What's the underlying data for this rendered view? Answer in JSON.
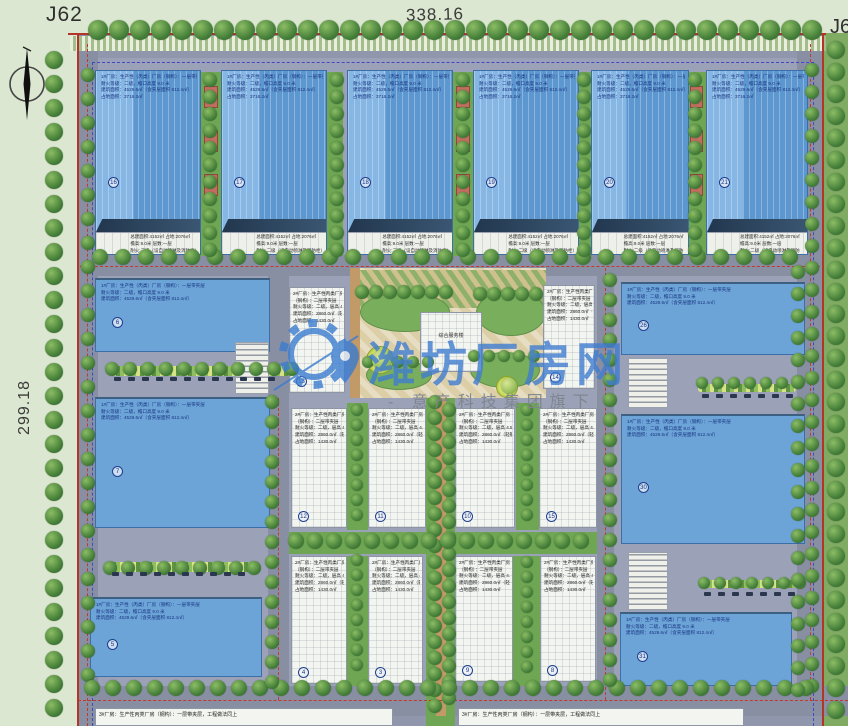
{
  "title_labels": {
    "top_left": "J62",
    "top_right": "J63",
    "top_dim": "338.16",
    "left_dim": "299.18"
  },
  "watermark": {
    "title": "潍坊厂房网",
    "subtitle": "-  意产科技集团旗下",
    "title_color": "#3b7cd0",
    "subtitle_color": "#8e949c"
  },
  "central_building_label": "综合服务楼",
  "annotations": {
    "blue_lines": [
      "1#厂房：生产性（丙类）厂房（钢构）：一层带夹层",
      "耐火等级：二级，檐口高度 9.0 米",
      "建筑面积：4529.6㎡（含夹层面积 812.4㎡）",
      "占地面积：3716.2㎡"
    ],
    "white_lines": [
      "2#厂房：生产性丙类厂房（砼框架）",
      "（钢构）：二层带夹层",
      "耐火等级：二级，层高 4.5 米",
      "建筑面积：2860.0㎡（轻钢屋面彩钢板）",
      "占地面积：1430.0㎡"
    ],
    "band_lines": [
      "总建面积:4152㎡ 占地:2076㎡",
      "檐高:9.0米 层数:一层",
      "耐火:二级（设自动喷淋及消防栓）"
    ],
    "bottom_lines": [
      "3#厂房：生产性丙类厂房（钢构）：一层带夹层，工程做法同上"
    ]
  },
  "colors": {
    "roof_blue_light": "#86b6e4",
    "roof_blue": "#5d97d0",
    "ridge_navy": "#22374e",
    "ground_grey": "#9096ab",
    "boundary_red": "#b23527",
    "inner_dash_blue": "#3f49c4",
    "tree_green": "#46803a",
    "plaza_tan": "#dccfa8",
    "outside_green": "#dbe7d0"
  },
  "layout": {
    "base": [
      77,
      33,
      747,
      693
    ],
    "right_green": [
      824,
      33,
      24,
      693
    ],
    "hedge_band": [
      70,
      36,
      756,
      15
    ],
    "lots": [
      [
        90,
        58,
        720,
        198
      ],
      [
        82,
        276,
        186,
        438
      ],
      [
        289,
        276,
        308,
        438
      ],
      [
        614,
        276,
        196,
        438
      ]
    ],
    "roads": [
      [
        77,
        33,
        21,
        693
      ],
      [
        797,
        33,
        27,
        681
      ],
      [
        77,
        255,
        747,
        21
      ],
      [
        77,
        686,
        771,
        30
      ],
      [
        268,
        258,
        21,
        468
      ],
      [
        597,
        258,
        17,
        468
      ]
    ],
    "greens": [
      [
        201,
        72,
        20,
        184
      ],
      [
        327,
        72,
        16,
        184
      ],
      [
        453,
        72,
        20,
        184
      ],
      [
        577,
        72,
        14,
        184
      ],
      [
        687,
        72,
        19,
        184
      ],
      [
        347,
        403,
        21,
        127
      ],
      [
        516,
        403,
        23,
        127
      ],
      [
        347,
        556,
        21,
        130
      ],
      [
        513,
        556,
        27,
        130
      ],
      [
        426,
        398,
        29,
        328
      ],
      [
        289,
        532,
        308,
        22
      ]
    ],
    "plaza": [
      356,
      268,
      190,
      130
    ],
    "field": [
      356,
      270,
      190,
      38
    ],
    "paths": [
      [
        350,
        268,
        10,
        130
      ],
      [
        436,
        398,
        10,
        318
      ]
    ],
    "lawns": [
      [
        360,
        292,
        90,
        40
      ],
      [
        476,
        290,
        70,
        46
      ],
      [
        366,
        360,
        66,
        30
      ],
      [
        470,
        352,
        70,
        36
      ]
    ],
    "ycircles": [
      [
        366,
        346,
        28
      ],
      [
        496,
        376,
        22
      ]
    ],
    "hedges": [
      [
        112,
        366,
        180,
        10
      ],
      [
        108,
        562,
        150,
        10
      ],
      [
        698,
        384,
        98,
        8
      ],
      [
        700,
        580,
        96,
        8
      ]
    ],
    "red_solid": [
      [
        68,
        33,
        758,
        2
      ],
      [
        77,
        33,
        2,
        693
      ],
      [
        822,
        33,
        2,
        693
      ]
    ],
    "red_dash_h": [
      [
        80,
        266,
        740
      ],
      [
        78,
        700,
        770
      ]
    ],
    "red_dash_v": [
      [
        87,
        44,
        682
      ],
      [
        278,
        398,
        302
      ],
      [
        605,
        268,
        432
      ],
      [
        810,
        44,
        656
      ]
    ],
    "blue_dash": [
      92,
      62,
      722,
      664
    ],
    "car_rows": [
      [
        114,
        377,
        14,
        12
      ],
      [
        112,
        572,
        14,
        10
      ],
      [
        702,
        394,
        14,
        7
      ],
      [
        704,
        592,
        14,
        7
      ]
    ],
    "tree_rows": [
      [
        98,
        30,
        21,
        0,
        35,
        10
      ],
      [
        54,
        60,
        0,
        24,
        28,
        9
      ],
      [
        836,
        50,
        0,
        22,
        31,
        9
      ],
      [
        100,
        257,
        23,
        0,
        31,
        8
      ],
      [
        88,
        75,
        0,
        24,
        26,
        7
      ],
      [
        812,
        70,
        0,
        22,
        29,
        7
      ],
      [
        210,
        80,
        0,
        17,
        11,
        7
      ],
      [
        337,
        80,
        0,
        17,
        11,
        7
      ],
      [
        463,
        80,
        0,
        17,
        11,
        7
      ],
      [
        584,
        80,
        0,
        17,
        11,
        7
      ],
      [
        695,
        80,
        0,
        17,
        11,
        7
      ],
      [
        435,
        402,
        0,
        16,
        20,
        7
      ],
      [
        449,
        410,
        0,
        16,
        19,
        7
      ],
      [
        357,
        410,
        0,
        15,
        8,
        6
      ],
      [
        527,
        410,
        0,
        15,
        8,
        6
      ],
      [
        357,
        560,
        0,
        15,
        8,
        6
      ],
      [
        527,
        562,
        0,
        15,
        8,
        6
      ],
      [
        296,
        541,
        19,
        0,
        16,
        8
      ],
      [
        92,
        688,
        21,
        0,
        35,
        8
      ],
      [
        112,
        369,
        18,
        0,
        11,
        7
      ],
      [
        110,
        568,
        18,
        0,
        9,
        7
      ],
      [
        702,
        383,
        16,
        0,
        7,
        6
      ],
      [
        704,
        583,
        16,
        0,
        7,
        6
      ],
      [
        272,
        402,
        0,
        20,
        15,
        7
      ],
      [
        610,
        280,
        0,
        20,
        21,
        7
      ],
      [
        798,
        272,
        0,
        22,
        20,
        7
      ],
      [
        362,
        292,
        14,
        0,
        7,
        7
      ],
      [
        480,
        294,
        14,
        0,
        5,
        7
      ],
      [
        368,
        362,
        15,
        0,
        5,
        6
      ],
      [
        474,
        356,
        15,
        0,
        5,
        6
      ],
      [
        382,
        360,
        0,
        0,
        1,
        10,
        "light"
      ],
      [
        509,
        386,
        0,
        0,
        1,
        8,
        "light"
      ]
    ],
    "buildings": [
      {
        "k": "tb",
        "x": 95,
        "y": 70,
        "w": 106,
        "h": 185,
        "num": "16"
      },
      {
        "k": "tb",
        "x": 221,
        "y": 70,
        "w": 106,
        "h": 185,
        "num": "17"
      },
      {
        "k": "tb",
        "x": 347,
        "y": 70,
        "w": 106,
        "h": 185,
        "num": "18"
      },
      {
        "k": "tb",
        "x": 473,
        "y": 70,
        "w": 106,
        "h": 185,
        "num": "19"
      },
      {
        "k": "tb",
        "x": 591,
        "y": 70,
        "w": 98,
        "h": 185,
        "num": "20"
      },
      {
        "k": "tb",
        "x": 706,
        "y": 70,
        "w": 102,
        "h": 185,
        "num": "21"
      },
      {
        "k": "wb",
        "x": 95,
        "y": 278,
        "w": 175,
        "h": 74,
        "num": "6"
      },
      {
        "k": "wb",
        "x": 95,
        "y": 397,
        "w": 175,
        "h": 131,
        "num": "7"
      },
      {
        "k": "wb",
        "x": 90,
        "y": 597,
        "w": 172,
        "h": 80,
        "num": "5"
      },
      {
        "k": "wb",
        "x": 621,
        "y": 282,
        "w": 184,
        "h": 73,
        "num": "26"
      },
      {
        "k": "wb",
        "x": 621,
        "y": 414,
        "w": 184,
        "h": 130,
        "num": "30"
      },
      {
        "k": "wb",
        "x": 620,
        "y": 612,
        "w": 172,
        "h": 74,
        "num": "31"
      },
      {
        "k": "wh",
        "x": 289,
        "y": 287,
        "w": 56,
        "h": 106,
        "num": "13"
      },
      {
        "k": "wh",
        "x": 543,
        "y": 285,
        "w": 52,
        "h": 104,
        "num": "14"
      },
      {
        "k": "wh",
        "x": 291,
        "y": 408,
        "w": 56,
        "h": 120,
        "num": "12"
      },
      {
        "k": "wh",
        "x": 368,
        "y": 408,
        "w": 58,
        "h": 120,
        "num": "11"
      },
      {
        "k": "wh",
        "x": 455,
        "y": 408,
        "w": 60,
        "h": 120,
        "num": "10"
      },
      {
        "k": "wh",
        "x": 539,
        "y": 408,
        "w": 58,
        "h": 120,
        "num": "15"
      },
      {
        "k": "wh",
        "x": 291,
        "y": 556,
        "w": 56,
        "h": 128,
        "num": "4"
      },
      {
        "k": "wh",
        "x": 368,
        "y": 556,
        "w": 55,
        "h": 128,
        "num": "3"
      },
      {
        "k": "wh",
        "x": 455,
        "y": 556,
        "w": 58,
        "h": 126,
        "num": "9"
      },
      {
        "k": "wh",
        "x": 540,
        "y": 556,
        "w": 56,
        "h": 126,
        "num": "8"
      },
      {
        "k": "central",
        "x": 420,
        "y": 312,
        "w": 62,
        "h": 60
      },
      {
        "k": "aw",
        "x": 235,
        "y": 342,
        "w": 34,
        "h": 52
      },
      {
        "k": "tan",
        "x": 215,
        "y": 348,
        "w": 18,
        "h": 44
      },
      {
        "k": "tan",
        "x": 215,
        "y": 545,
        "w": 22,
        "h": 50
      },
      {
        "k": "aw",
        "x": 628,
        "y": 358,
        "w": 40,
        "h": 50
      },
      {
        "k": "tan",
        "x": 670,
        "y": 356,
        "w": 16,
        "h": 48
      },
      {
        "k": "aw",
        "x": 628,
        "y": 552,
        "w": 40,
        "h": 58
      },
      {
        "k": "tan",
        "x": 670,
        "y": 554,
        "w": 16,
        "h": 44
      },
      {
        "k": "hut",
        "x": 204,
        "y": 86,
        "w": 14,
        "h": 22
      },
      {
        "k": "hut",
        "x": 204,
        "y": 130,
        "w": 14,
        "h": 22
      },
      {
        "k": "hut",
        "x": 204,
        "y": 174,
        "w": 14,
        "h": 22
      },
      {
        "k": "hut",
        "x": 456,
        "y": 86,
        "w": 14,
        "h": 22
      },
      {
        "k": "hut",
        "x": 456,
        "y": 130,
        "w": 14,
        "h": 22
      },
      {
        "k": "hut",
        "x": 456,
        "y": 174,
        "w": 14,
        "h": 22
      },
      {
        "k": "hut",
        "x": 690,
        "y": 86,
        "w": 13,
        "h": 22
      },
      {
        "k": "hut",
        "x": 690,
        "y": 130,
        "w": 13,
        "h": 22
      },
      {
        "k": "hut",
        "x": 690,
        "y": 174,
        "w": 13,
        "h": 22
      },
      {
        "k": "pw",
        "x": 95,
        "y": 708,
        "w": 298,
        "h": 18
      },
      {
        "k": "pw",
        "x": 458,
        "y": 708,
        "w": 286,
        "h": 18
      }
    ]
  }
}
